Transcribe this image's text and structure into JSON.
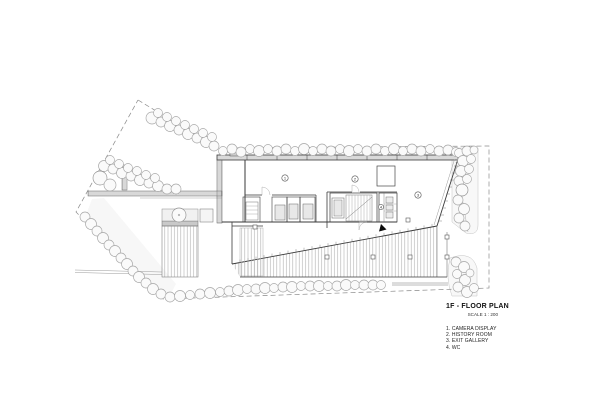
{
  "titleblock": {
    "title": "1F - FLOOR PLAN",
    "scale": "SCALE 1 : 200"
  },
  "legend": {
    "items": [
      "1. CAMERA DISPLAY",
      "2. HISTORY ROOM",
      "3. EXIT GALLERY",
      "4. WC"
    ]
  },
  "plan": {
    "room_tags": [
      {
        "number": "1"
      },
      {
        "number": "2"
      },
      {
        "number": "3"
      },
      {
        "number": "4"
      }
    ],
    "colors": {
      "paper": "#ffffff",
      "wall": "#3a3a3a",
      "line": "#777777",
      "tree_stroke": "#a6a6a6",
      "landscape_fill": "#f7f7f7"
    }
  }
}
